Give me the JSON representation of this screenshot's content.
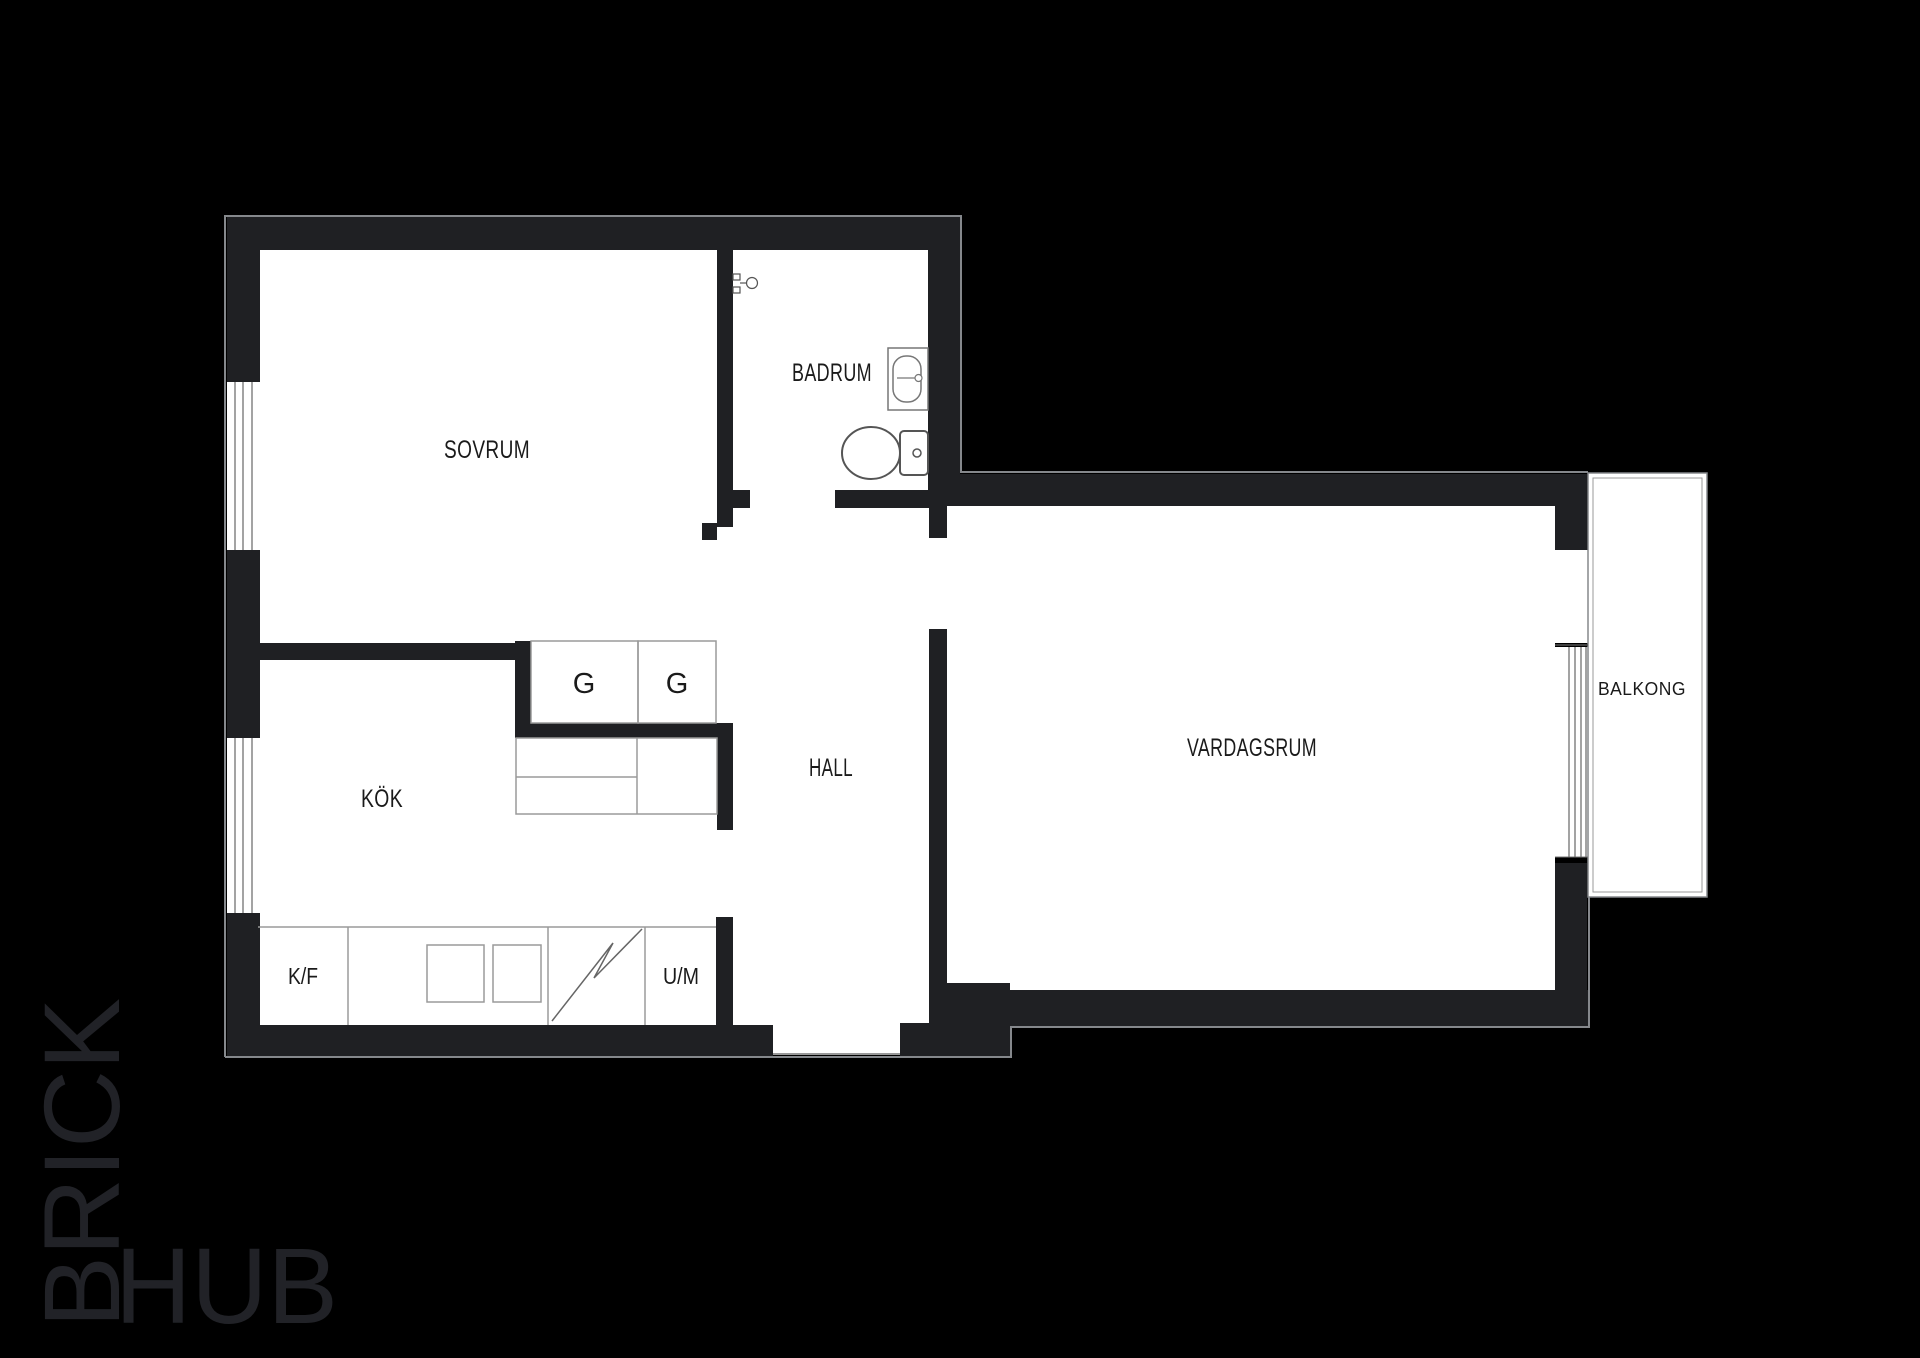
{
  "floorplan": {
    "rooms": [
      {
        "id": "sovrum",
        "label": "SOVRUM"
      },
      {
        "id": "badrum",
        "label": "BADRUM"
      },
      {
        "id": "kok",
        "label": "KÖK"
      },
      {
        "id": "hall",
        "label": "HALL"
      },
      {
        "id": "vardagsrum",
        "label": "VARDAGSRUM"
      },
      {
        "id": "balkong",
        "label": "BALKONG"
      }
    ],
    "closets": [
      "G",
      "G"
    ],
    "appliances": [
      {
        "id": "kf",
        "label": "K/F"
      },
      {
        "id": "um",
        "label": "U/M"
      }
    ]
  },
  "watermark": {
    "brand_top": "BRICK",
    "brand_bottom": "HUB"
  },
  "colors": {
    "background": "#000000",
    "wall": "#1f2023",
    "floor": "#ffffff",
    "outline": "#85888c",
    "detail_line": "#9a9a9a",
    "fixture_line": "#5a5a5a",
    "label": "#1a1a1a",
    "watermark": "#212227"
  }
}
